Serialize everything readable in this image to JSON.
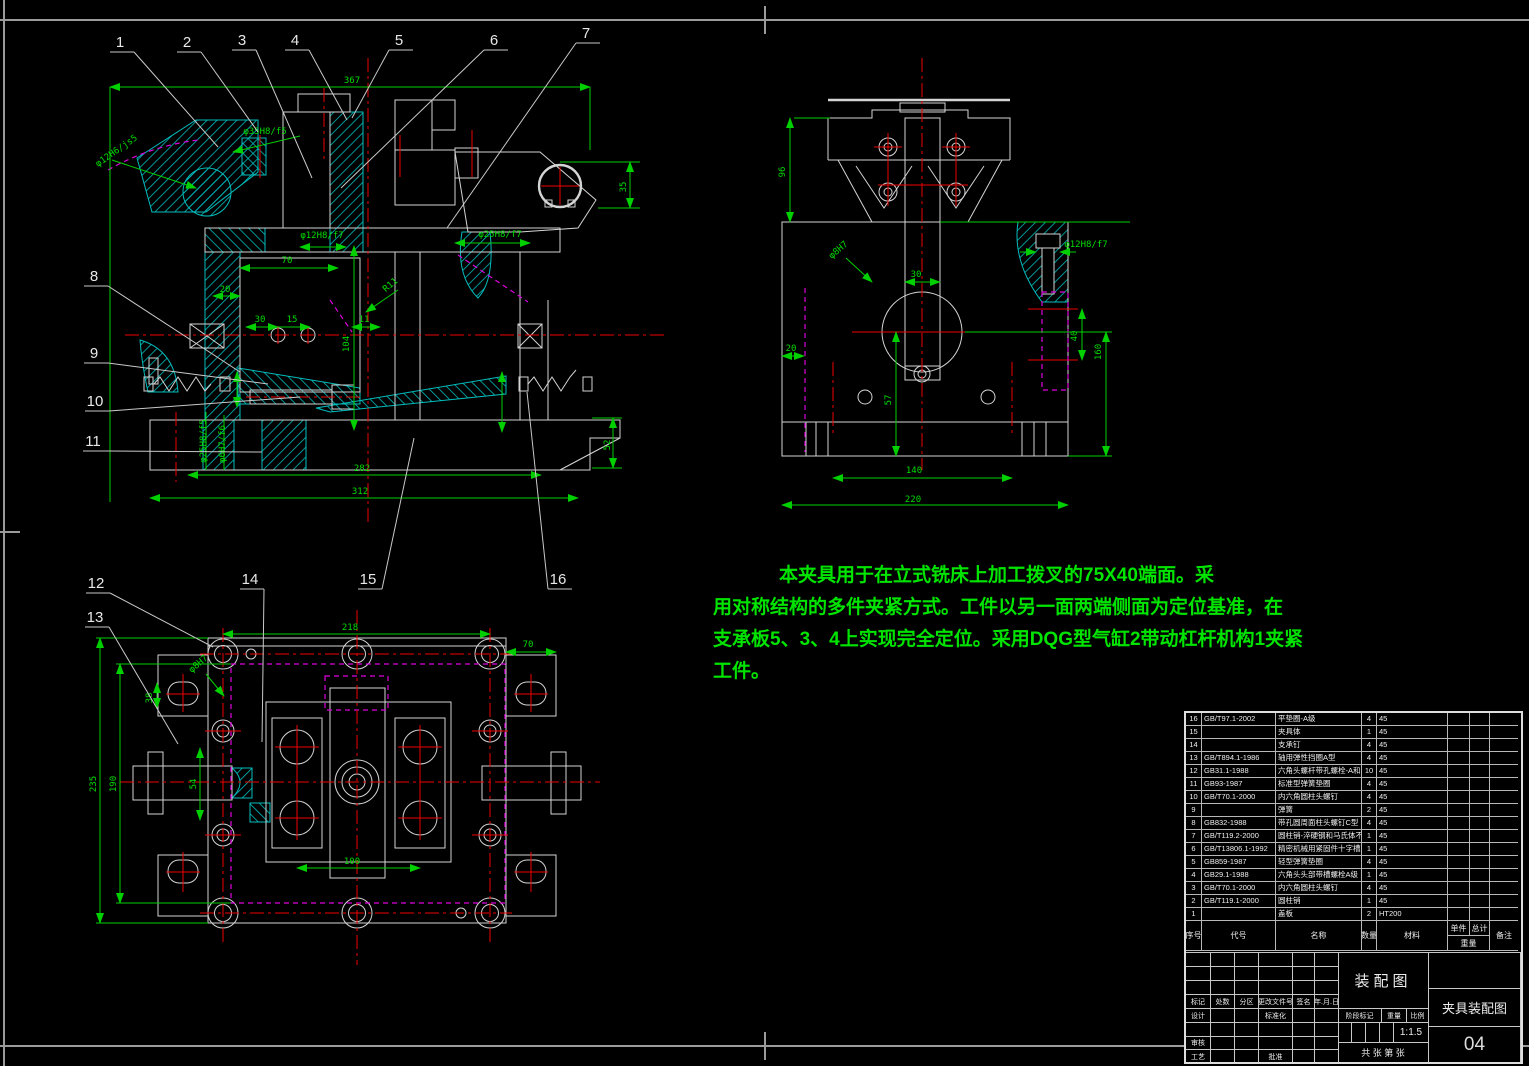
{
  "sheet": {
    "view_title": "装配图",
    "sheet_title": "夹具装配图",
    "drawing_no": "04",
    "scale": "1:1.5",
    "sheets_text": "共    张  第    张"
  },
  "colors": {
    "background": "#000000",
    "line_white": "#d4d4d4",
    "dimension_green": "#00dc00",
    "centerline_red": "#ee0000",
    "hidden_magenta": "#dd00dd",
    "hatch_cyan": "#00bcbc",
    "note_green": "#00e400"
  },
  "notes": {
    "line1": "本夹具用于在立式铣床上加工拨叉的75X40端面。采",
    "line2": "用对称结构的多件夹紧方式。工件以另一面两端侧面为定位基准，在",
    "line3": "支承板5、3、4上实现完全定位。采用DQG型气缸2带动杠杆机构1夹紧",
    "line4": "工件。"
  },
  "balloons": [
    {
      "n": "1",
      "x": 120,
      "y": 47,
      "tx": 218,
      "ty": 147
    },
    {
      "n": "2",
      "x": 187,
      "y": 47,
      "tx": 258,
      "ty": 132
    },
    {
      "n": "3",
      "x": 242,
      "y": 45,
      "tx": 312,
      "ty": 178
    },
    {
      "n": "4",
      "x": 295,
      "y": 45,
      "tx": 347,
      "ty": 120
    },
    {
      "n": "5",
      "x": 399,
      "y": 45,
      "tx": 352,
      "ty": 118
    },
    {
      "n": "6",
      "x": 494,
      "y": 45,
      "tx": 341,
      "ty": 188
    },
    {
      "n": "7",
      "x": 586,
      "y": 38,
      "tx": 447,
      "ty": 228
    },
    {
      "n": "8",
      "x": 94,
      "y": 281,
      "tx": 240,
      "ty": 372
    },
    {
      "n": "9",
      "x": 94,
      "y": 358,
      "tx": 268,
      "ty": 384
    },
    {
      "n": "10",
      "x": 95,
      "y": 406,
      "tx": 300,
      "ty": 397
    },
    {
      "n": "11",
      "x": 93,
      "y": 446,
      "tx": 262,
      "ty": 452
    },
    {
      "n": "12",
      "x": 96,
      "y": 588,
      "tx": 213,
      "ty": 647
    },
    {
      "n": "13",
      "x": 95,
      "y": 622,
      "tx": 178,
      "ty": 744
    },
    {
      "n": "14",
      "x": 250,
      "y": 584,
      "tx": 262,
      "ty": 742
    },
    {
      "n": "15",
      "x": 368,
      "y": 584,
      "tx": 414,
      "ty": 438
    },
    {
      "n": "16",
      "x": 558,
      "y": 584,
      "tx": 527,
      "ty": 392
    }
  ],
  "dimensions": [
    {
      "t": "367",
      "x": 352,
      "y": 83
    },
    {
      "t": "φ35H8/f5",
      "x": 265,
      "y": 134
    },
    {
      "t": "φ12H6/js5",
      "x": 118,
      "y": 153,
      "r": -35
    },
    {
      "t": "φ12H8/f7",
      "x": 322,
      "y": 238
    },
    {
      "t": "φ25H8/f7",
      "x": 500,
      "y": 237
    },
    {
      "t": "R11",
      "x": 392,
      "y": 287,
      "r": -40
    },
    {
      "t": "70",
      "x": 287,
      "y": 263
    },
    {
      "t": "20",
      "x": 225,
      "y": 292
    },
    {
      "t": "30",
      "x": 260,
      "y": 322
    },
    {
      "t": "15",
      "x": 292,
      "y": 322
    },
    {
      "t": "11",
      "x": 364,
      "y": 322
    },
    {
      "t": "104",
      "x": 349,
      "y": 344,
      "r": -90
    },
    {
      "t": "35",
      "x": 626,
      "y": 187,
      "r": -90
    },
    {
      "t": "52",
      "x": 610,
      "y": 445,
      "r": -90
    },
    {
      "t": "φ25H8/f5",
      "x": 206,
      "y": 441,
      "r": -90
    },
    {
      "t": "φ6H7/f6",
      "x": 225,
      "y": 444,
      "r": -90
    },
    {
      "t": "282",
      "x": 362,
      "y": 471
    },
    {
      "t": "312",
      "x": 360,
      "y": 494
    },
    {
      "t": "96",
      "x": 785,
      "y": 172,
      "r": -90
    },
    {
      "t": "φ8H7",
      "x": 840,
      "y": 252,
      "r": -40
    },
    {
      "t": "φ12H8/f7",
      "x": 1086,
      "y": 247
    },
    {
      "t": "30",
      "x": 916,
      "y": 277
    },
    {
      "t": "20",
      "x": 791,
      "y": 351
    },
    {
      "t": "40",
      "x": 1077,
      "y": 336,
      "r": -90
    },
    {
      "t": "160",
      "x": 1101,
      "y": 352,
      "r": -90
    },
    {
      "t": "57",
      "x": 891,
      "y": 400,
      "r": -90
    },
    {
      "t": "140",
      "x": 914,
      "y": 473
    },
    {
      "t": "220",
      "x": 913,
      "y": 502
    },
    {
      "t": "218",
      "x": 350,
      "y": 630
    },
    {
      "t": "70",
      "x": 528,
      "y": 647
    },
    {
      "t": "φ8H7",
      "x": 200,
      "y": 666,
      "r": -40
    },
    {
      "t": "38",
      "x": 152,
      "y": 698,
      "r": -90
    },
    {
      "t": "235",
      "x": 96,
      "y": 784,
      "r": -90
    },
    {
      "t": "190",
      "x": 116,
      "y": 784,
      "r": -90
    },
    {
      "t": "54",
      "x": 196,
      "y": 784,
      "r": -90
    },
    {
      "t": "100",
      "x": 352,
      "y": 864
    }
  ],
  "bom": {
    "headers": {
      "no": "序号",
      "code": "代号",
      "name": "名称",
      "qty": "数量",
      "material": "材料",
      "single": "单件",
      "total": "总计",
      "weight": "重量",
      "remark": "备注"
    },
    "rows": [
      [
        "16",
        "GB/T97.1-2002",
        "平垫圈-A级",
        "4",
        "45"
      ],
      [
        "15",
        "",
        "夹具体",
        "1",
        "45"
      ],
      [
        "14",
        "",
        "支承钉",
        "4",
        "45"
      ],
      [
        "13",
        "GB/T894.1-1986",
        "轴用弹性挡圈A型",
        "4",
        "45"
      ],
      [
        "12",
        "GB31.1-1988",
        "六角头螺杆带孔螺栓-A和B级",
        "10",
        "45"
      ],
      [
        "11",
        "GB93-1987",
        "标准型弹簧垫圈",
        "4",
        "45"
      ],
      [
        "10",
        "GB/T70.1-2000",
        "内六角圆柱头螺钉",
        "4",
        "45"
      ],
      [
        "9",
        "",
        "弹簧",
        "2",
        "45"
      ],
      [
        "8",
        "GB832-1988",
        "带孔圆周面柱头螺钉C型",
        "4",
        "45"
      ],
      [
        "7",
        "GB/T119.2-2000",
        "圆柱销-淬硬钢和马氏体不锈钢",
        "1",
        "45"
      ],
      [
        "6",
        "GB/T13806.1-1992",
        "精密机械用紧固件十字槽螺钉",
        "1",
        "45"
      ],
      [
        "5",
        "GB859-1987",
        "轻型弹簧垫圈",
        "4",
        "45"
      ],
      [
        "4",
        "GB29.1-1988",
        "六角头头部带槽螺栓A级",
        "1",
        "45"
      ],
      [
        "3",
        "GB/T70.1-2000",
        "内六角圆柱头螺钉",
        "4",
        "45"
      ],
      [
        "2",
        "GB/T119.1-2000",
        "圆柱销",
        "1",
        "45"
      ],
      [
        "1",
        "",
        "盖板",
        "2",
        "HT200"
      ]
    ]
  },
  "titleblock": {
    "mark": "标记",
    "count": "处数",
    "zone": "分区",
    "change_doc": "更改文件号",
    "sign": "签名",
    "date": "年.月.日",
    "design": "设计",
    "standardize": "标准化",
    "check": "审核",
    "process": "工艺",
    "approve": "批准",
    "stage": "阶段标记",
    "weight": "重量",
    "scale_label": "比例"
  }
}
